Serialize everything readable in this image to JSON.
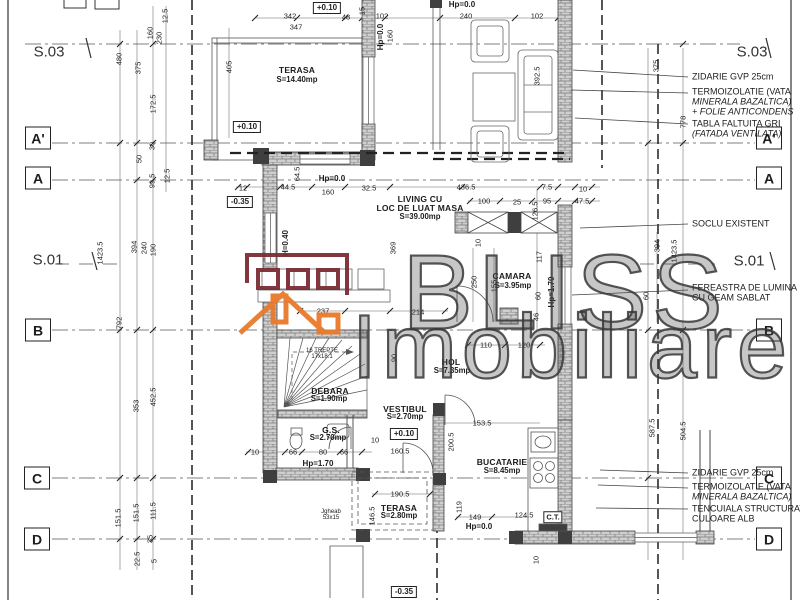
{
  "watermark": {
    "line1": "BLISS",
    "line2": "Imobiliare"
  },
  "colors": {
    "logo_maroon": "#7c2d35",
    "logo_orange": "#e87a2c",
    "line": "#444444",
    "wall_fill": "#cfcfcf"
  },
  "texts": [
    {
      "t": "A'",
      "x": 38,
      "y": 138,
      "c": "axis",
      "n": "axis-a-prime-left"
    },
    {
      "t": "A",
      "x": 38,
      "y": 178,
      "c": "axis",
      "n": "axis-a-left"
    },
    {
      "t": "B",
      "x": 38,
      "y": 330,
      "c": "axis",
      "n": "axis-b-left"
    },
    {
      "t": "C",
      "x": 37,
      "y": 478,
      "c": "axis",
      "n": "axis-c-left"
    },
    {
      "t": "D",
      "x": 37,
      "y": 539,
      "c": "axis",
      "n": "axis-d-left"
    },
    {
      "t": "A'",
      "x": 769,
      "y": 138,
      "c": "axis",
      "n": "axis-a-prime-right"
    },
    {
      "t": "A",
      "x": 769,
      "y": 178,
      "c": "axis",
      "n": "axis-a-right"
    },
    {
      "t": "B",
      "x": 769,
      "y": 330,
      "c": "axis",
      "n": "axis-b-right"
    },
    {
      "t": "C",
      "x": 769,
      "y": 478,
      "c": "axis",
      "n": "axis-c-right"
    },
    {
      "t": "D",
      "x": 769,
      "y": 539,
      "c": "axis",
      "n": "axis-d-right"
    },
    {
      "t": "S.03",
      "x": 49,
      "y": 52,
      "c": "sect",
      "n": "section-s03-left"
    },
    {
      "t": "S.03",
      "x": 752,
      "y": 52,
      "c": "sect",
      "n": "section-s03-right"
    },
    {
      "t": "S.01",
      "x": 48,
      "y": 260,
      "c": "sect",
      "n": "section-s01-left"
    },
    {
      "t": "S.01",
      "x": 749,
      "y": 261,
      "c": "sect",
      "n": "section-s01-right"
    },
    {
      "t": "TERASA",
      "x": 297,
      "y": 70,
      "c": "room",
      "n": "room-terasa-top"
    },
    {
      "t": "S=14.40mp",
      "x": 297,
      "y": 80,
      "c": "area",
      "n": "room-terasa-top-area"
    },
    {
      "t": "LIVING CU",
      "x": 420,
      "y": 199,
      "c": "room",
      "n": "room-living"
    },
    {
      "t": "LOC DE LUAT MASA",
      "x": 420,
      "y": 208,
      "c": "room",
      "n": "room-living-2"
    },
    {
      "t": "S=39.00mp",
      "x": 420,
      "y": 217,
      "c": "area",
      "n": "room-living-area"
    },
    {
      "t": "CAMARA",
      "x": 512,
      "y": 276,
      "c": "room",
      "n": "room-camara"
    },
    {
      "t": "S=3.95mp",
      "x": 513,
      "y": 286,
      "c": "area",
      "n": "room-camara-area"
    },
    {
      "t": "HOL",
      "x": 451,
      "y": 362,
      "c": "room",
      "n": "room-hol"
    },
    {
      "t": "S=7.35mp",
      "x": 452,
      "y": 371,
      "c": "area",
      "n": "room-hol-area"
    },
    {
      "t": "DEBARA",
      "x": 330,
      "y": 391,
      "c": "room",
      "n": "room-debara"
    },
    {
      "t": "S=1.90mp",
      "x": 329,
      "y": 399,
      "c": "area",
      "n": "room-debara-area"
    },
    {
      "t": "VESTIBUL",
      "x": 405,
      "y": 409,
      "c": "room",
      "n": "room-vestibul"
    },
    {
      "t": "S=2.70mp",
      "x": 405,
      "y": 417,
      "c": "area",
      "n": "room-vestibul-area"
    },
    {
      "t": "G.S.",
      "x": 331,
      "y": 430,
      "c": "room",
      "n": "room-gs"
    },
    {
      "t": "S=2.70mp",
      "x": 328,
      "y": 438,
      "c": "area",
      "n": "room-gs-area"
    },
    {
      "t": "BUCATARIE",
      "x": 502,
      "y": 462,
      "c": "room",
      "n": "room-bucatarie"
    },
    {
      "t": "S=8.45mp",
      "x": 502,
      "y": 471,
      "c": "area",
      "n": "room-bucatarie-area"
    },
    {
      "t": "TERASA",
      "x": 399,
      "y": 508,
      "c": "room",
      "n": "room-terasa-bottom"
    },
    {
      "t": "S=2.80mp",
      "x": 399,
      "y": 516,
      "c": "area",
      "n": "room-terasa-bottom-area"
    },
    {
      "t": "+0.10",
      "x": 327,
      "y": 8,
      "c": "lvlbox",
      "n": "level-plus010-top"
    },
    {
      "t": "Hp=0.0",
      "x": 462,
      "y": 5,
      "c": "lvl",
      "n": "level-hp00-top"
    },
    {
      "t": "Hp=0.0",
      "x": 381,
      "y": 37,
      "c": "lvl",
      "r": 1,
      "n": "level-hp00-wall"
    },
    {
      "t": "+0.10",
      "x": 247,
      "y": 127,
      "c": "lvlbox",
      "n": "level-plus010-terasa"
    },
    {
      "t": "Hp=0.0",
      "x": 332,
      "y": 179,
      "c": "lvl",
      "n": "level-hp00-living"
    },
    {
      "t": "-0.35",
      "x": 240,
      "y": 202,
      "c": "lvlbox",
      "n": "level-minus035-left"
    },
    {
      "t": "H=0.40",
      "x": 286,
      "y": 243,
      "c": "lvl",
      "r": 1,
      "n": "level-h040"
    },
    {
      "t": "Hp=1.70",
      "x": 552,
      "y": 292,
      "c": "lvl",
      "r": 1,
      "n": "level-hp170-camara"
    },
    {
      "t": "+0.10",
      "x": 404,
      "y": 434,
      "c": "lvlbox",
      "n": "level-plus010-vestibul"
    },
    {
      "t": "Hp=1.70",
      "x": 318,
      "y": 464,
      "c": "lvl",
      "n": "level-hp170-gs"
    },
    {
      "t": "Hp=0.0",
      "x": 479,
      "y": 527,
      "c": "lvl",
      "n": "level-hp00-bottom"
    },
    {
      "t": "-0.35",
      "x": 404,
      "y": 592,
      "c": "lvlbox",
      "n": "level-minus035-bottom"
    },
    {
      "t": "C.T.",
      "x": 553,
      "y": 517,
      "c": "ct",
      "n": "ct-label"
    },
    {
      "t": "ZIDARIE GVP 25cm",
      "x": 692,
      "y": 77,
      "c": "call",
      "n": "callout-zidarie-top"
    },
    {
      "t": "TERMOIZOLATIE (VATA",
      "x": 692,
      "y": 92,
      "c": "call",
      "n": "callout-termo-top-1"
    },
    {
      "t": "MINERALA BAZALTICA)",
      "x": 692,
      "y": 102,
      "c": "calli",
      "n": "callout-termo-top-2"
    },
    {
      "t": "+ FOLIE ANTICONDENS",
      "x": 692,
      "y": 112,
      "c": "calli",
      "n": "callout-termo-top-3"
    },
    {
      "t": "TABLA FALTUITA GRI",
      "x": 692,
      "y": 124,
      "c": "call",
      "n": "callout-tabla-1"
    },
    {
      "t": "(FATADA VENTILATA)",
      "x": 692,
      "y": 134,
      "c": "calli",
      "n": "callout-tabla-2"
    },
    {
      "t": "SOCLU EXISTENT",
      "x": 692,
      "y": 224,
      "c": "call",
      "n": "callout-soclu"
    },
    {
      "t": "FEREASTRA DE LUMINA",
      "x": 692,
      "y": 288,
      "c": "call",
      "n": "callout-fereastra-1"
    },
    {
      "t": "CU GEAM SABLAT",
      "x": 692,
      "y": 298,
      "c": "call",
      "n": "callout-fereastra-2"
    },
    {
      "t": "ZIDARIE GVP 25cm",
      "x": 692,
      "y": 473,
      "c": "call",
      "n": "callout-zidarie-bottom"
    },
    {
      "t": "TERMOIZOLATIE (VATA",
      "x": 692,
      "y": 487,
      "c": "call",
      "n": "callout-termo-bottom-1"
    },
    {
      "t": "MINERALA BAZALTICA)",
      "x": 692,
      "y": 497,
      "c": "calli",
      "n": "callout-termo-bottom-2"
    },
    {
      "t": "TENCUIALA STRUCTURATA",
      "x": 692,
      "y": 509,
      "c": "call",
      "n": "callout-tencuiala-1"
    },
    {
      "t": "CULOARE ALB",
      "x": 692,
      "y": 519,
      "c": "call",
      "n": "callout-tencuiala-2"
    },
    {
      "t": "16 TREPTE",
      "x": 322,
      "y": 351,
      "c": "tiny",
      "n": "stair-note-1"
    },
    {
      "t": "17x18.1",
      "x": 322,
      "y": 357,
      "c": "tiny",
      "n": "stair-note-2"
    },
    {
      "t": "Jgheab",
      "x": 331,
      "y": 512,
      "c": "tiny",
      "n": "jgheab-note-1"
    },
    {
      "t": "53x15",
      "x": 331,
      "y": 518,
      "c": "tiny",
      "n": "jgheab-note-2"
    },
    {
      "t": "480",
      "x": 119,
      "y": 59,
      "r": 1
    },
    {
      "t": "375",
      "x": 138,
      "y": 68,
      "r": 1
    },
    {
      "t": "160",
      "x": 150,
      "y": 33,
      "r": 1
    },
    {
      "t": "230",
      "x": 159,
      "y": 38,
      "r": 1
    },
    {
      "t": "12.5",
      "x": 165,
      "y": 16,
      "r": 1
    },
    {
      "t": "172.5",
      "x": 153,
      "y": 104,
      "r": 1
    },
    {
      "t": "405",
      "x": 229,
      "y": 67,
      "r": 1
    },
    {
      "t": "342",
      "x": 290,
      "y": 16
    },
    {
      "t": "347",
      "x": 296,
      "y": 27
    },
    {
      "t": "48",
      "x": 346,
      "y": 17
    },
    {
      "t": "15",
      "x": 362,
      "y": 11,
      "r": 1
    },
    {
      "t": "102",
      "x": 382,
      "y": 16
    },
    {
      "t": "240",
      "x": 466,
      "y": 16
    },
    {
      "t": "102",
      "x": 537,
      "y": 16
    },
    {
      "t": "160",
      "x": 390,
      "y": 36,
      "r": 1
    },
    {
      "t": "392.5",
      "x": 537,
      "y": 76,
      "r": 1
    },
    {
      "t": "375",
      "x": 656,
      "y": 66,
      "r": 1
    },
    {
      "t": "778",
      "x": 683,
      "y": 122,
      "r": 1
    },
    {
      "t": "99.5",
      "x": 152,
      "y": 181,
      "r": 1
    },
    {
      "t": "12.5",
      "x": 167,
      "y": 176,
      "r": 1
    },
    {
      "t": "50",
      "x": 139,
      "y": 159,
      "r": 1
    },
    {
      "t": "30",
      "x": 152,
      "y": 146,
      "r": 1
    },
    {
      "t": "12",
      "x": 243,
      "y": 188
    },
    {
      "t": "44.5",
      "x": 288,
      "y": 187
    },
    {
      "t": "64.5",
      "x": 297,
      "y": 174,
      "r": 1
    },
    {
      "t": "160",
      "x": 328,
      "y": 192
    },
    {
      "t": "32.5",
      "x": 369,
      "y": 188
    },
    {
      "t": "436.5",
      "x": 466,
      "y": 187
    },
    {
      "t": "7.5",
      "x": 547,
      "y": 187
    },
    {
      "t": "10",
      "x": 583,
      "y": 189
    },
    {
      "t": "100",
      "x": 484,
      "y": 201
    },
    {
      "t": "25",
      "x": 517,
      "y": 202
    },
    {
      "t": "95",
      "x": 547,
      "y": 201
    },
    {
      "t": "47.5",
      "x": 582,
      "y": 201
    },
    {
      "t": "126.5",
      "x": 535,
      "y": 211,
      "r": 1
    },
    {
      "t": "10",
      "x": 478,
      "y": 243,
      "r": 1
    },
    {
      "t": "117",
      "x": 539,
      "y": 257,
      "r": 1
    },
    {
      "t": "155",
      "x": 494,
      "y": 286,
      "r": 1
    },
    {
      "t": "250",
      "x": 474,
      "y": 282,
      "r": 1
    },
    {
      "t": "60",
      "x": 538,
      "y": 296,
      "r": 1
    },
    {
      "t": "46",
      "x": 536,
      "y": 317,
      "r": 1
    },
    {
      "t": "1423.5",
      "x": 100,
      "y": 253,
      "r": 1
    },
    {
      "t": "394",
      "x": 134,
      "y": 247,
      "r": 1
    },
    {
      "t": "240",
      "x": 144,
      "y": 248,
      "r": 1
    },
    {
      "t": "190",
      "x": 153,
      "y": 250,
      "r": 1
    },
    {
      "t": "792",
      "x": 119,
      "y": 323,
      "r": 1
    },
    {
      "t": "237",
      "x": 323,
      "y": 311
    },
    {
      "t": "214",
      "x": 418,
      "y": 312
    },
    {
      "t": "110",
      "x": 486,
      "y": 345
    },
    {
      "t": "120",
      "x": 524,
      "y": 345
    },
    {
      "t": "90",
      "x": 394,
      "y": 358,
      "r": 1
    },
    {
      "t": "369",
      "x": 393,
      "y": 248,
      "r": 1
    },
    {
      "t": "394",
      "x": 657,
      "y": 246,
      "r": 1
    },
    {
      "t": "1423.5",
      "x": 674,
      "y": 251,
      "r": 1
    },
    {
      "t": "60",
      "x": 646,
      "y": 296,
      "r": 1
    },
    {
      "t": "353",
      "x": 136,
      "y": 406,
      "r": 1
    },
    {
      "t": "452.5",
      "x": 153,
      "y": 397,
      "r": 1
    },
    {
      "t": "151.5",
      "x": 118,
      "y": 518,
      "r": 1
    },
    {
      "t": "151.5",
      "x": 136,
      "y": 513,
      "r": 1
    },
    {
      "t": "111.5",
      "x": 153,
      "y": 511,
      "r": 1
    },
    {
      "t": "35",
      "x": 150,
      "y": 539,
      "r": 1
    },
    {
      "t": "22.5",
      "x": 137,
      "y": 559,
      "r": 1
    },
    {
      "t": "5",
      "x": 154,
      "y": 561,
      "r": 1
    },
    {
      "t": "190.5",
      "x": 400,
      "y": 494
    },
    {
      "t": "146.5",
      "x": 372,
      "y": 516,
      "r": 1
    },
    {
      "t": "119",
      "x": 459,
      "y": 507,
      "r": 1
    },
    {
      "t": "149",
      "x": 475,
      "y": 517
    },
    {
      "t": "124.5",
      "x": 524,
      "y": 515
    },
    {
      "t": "200.5",
      "x": 451,
      "y": 442,
      "r": 1
    },
    {
      "t": "160.5",
      "x": 400,
      "y": 451
    },
    {
      "t": "10",
      "x": 375,
      "y": 440
    },
    {
      "t": "66",
      "x": 293,
      "y": 452
    },
    {
      "t": "80",
      "x": 323,
      "y": 452
    },
    {
      "t": "66",
      "x": 344,
      "y": 452
    },
    {
      "t": "10",
      "x": 255,
      "y": 452
    },
    {
      "t": "153.5",
      "x": 482,
      "y": 423
    },
    {
      "t": "10",
      "x": 536,
      "y": 560,
      "r": 1
    },
    {
      "t": "587.5",
      "x": 652,
      "y": 428,
      "r": 1
    },
    {
      "t": "504.5",
      "x": 683,
      "y": 431,
      "r": 1
    }
  ]
}
